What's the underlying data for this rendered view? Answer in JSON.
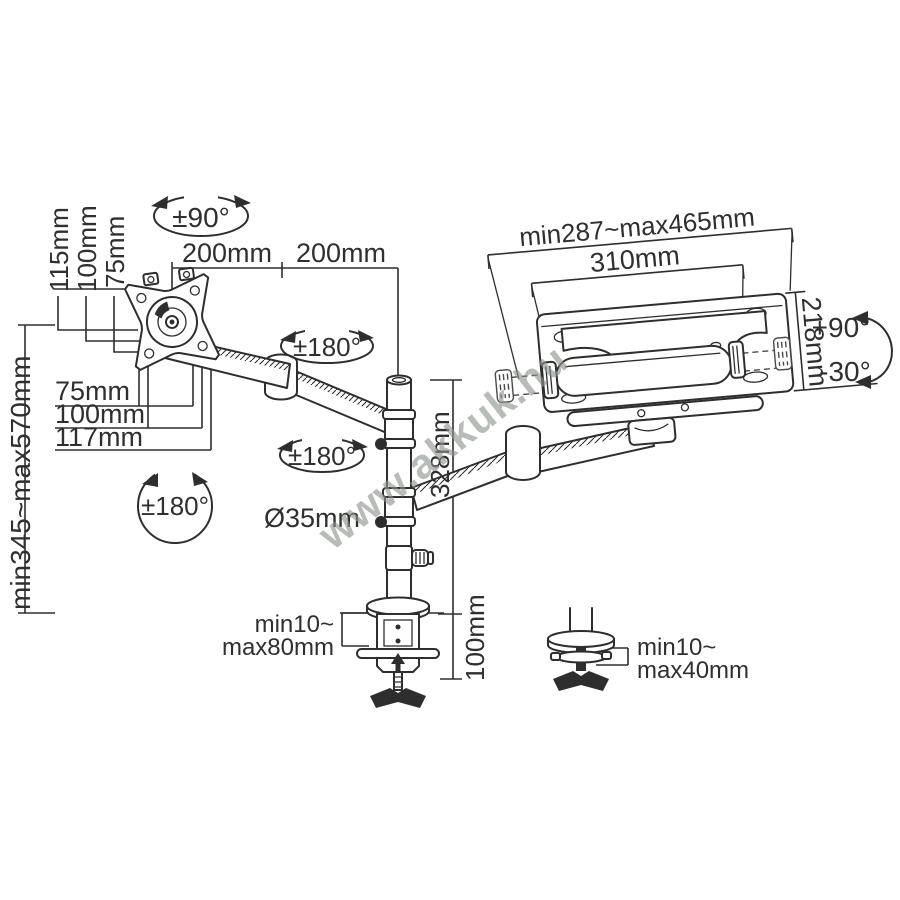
{
  "diagram": {
    "watermark": "www.akkuk.hu",
    "colors": {
      "line": "#2e2e2e",
      "text": "#2f2f2f",
      "watermark": "#8a958c",
      "background": "#ffffff"
    },
    "labels": {
      "rotation_vesa": "±90°",
      "arm_upper_segment1": "200mm",
      "arm_upper_segment2": "200mm",
      "vesa_vertical_115": "115mm",
      "vesa_vertical_100": "100mm",
      "vesa_vertical_75": "75mm",
      "vesa_horizontal_75": "75mm",
      "vesa_horizontal_100": "100mm",
      "vesa_horizontal_117": "117mm",
      "height_range": "min345~max570mm",
      "tray_width_range": "min287~max465mm",
      "tray_inner_width": "310mm",
      "tray_depth": "218mm",
      "tilt_up": "+90°",
      "tilt_down": "-30°",
      "swivel_upper": "±180°",
      "swivel_lower": "±180°",
      "swivel_base": "±180°",
      "pole_diameter": "Ø35mm",
      "pole_height": "328mm",
      "clamp_thickness_line1": "min10~",
      "clamp_thickness_line2": "max80mm",
      "clamp_below_desk": "100mm",
      "grommet_thickness_line1": "min10~",
      "grommet_thickness_line2": "max40mm"
    }
  }
}
